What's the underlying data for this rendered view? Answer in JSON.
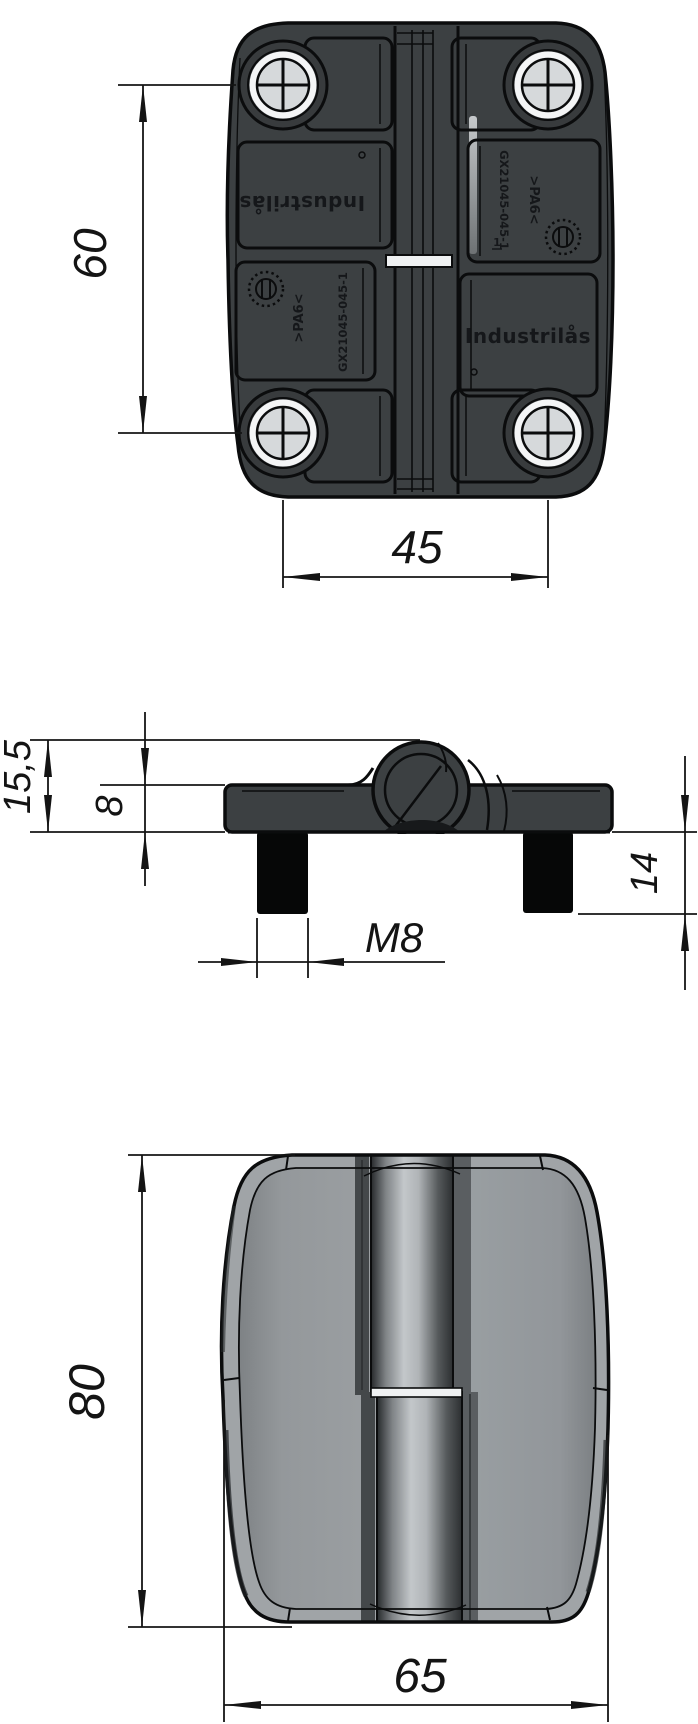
{
  "drawing_type": "hinge technical drawing, three views",
  "dimensions": {
    "d60": "60",
    "d45": "45",
    "d155": "15,5",
    "d8": "8",
    "d14": "14",
    "m8": "M8",
    "d80": "80",
    "d65": "65"
  },
  "markings": {
    "brand_reversed": "Industrilås",
    "brand": "Industrilås",
    "code_left": "GX21045-045-1",
    "code_right": "GX21045-045-1",
    "material_left": ">PA6<",
    "material_right": ">PA6<",
    "cavity_mark": "1"
  },
  "colors": {
    "line": "#0b0c0d",
    "dimension_line": "#141414",
    "body_dark": "#3c4042",
    "body_gray": "#8e9295",
    "screw_head": "#d6d9db",
    "gap_highlight": "#eff1f2",
    "barrel_highlight": "#c3c7ca"
  }
}
